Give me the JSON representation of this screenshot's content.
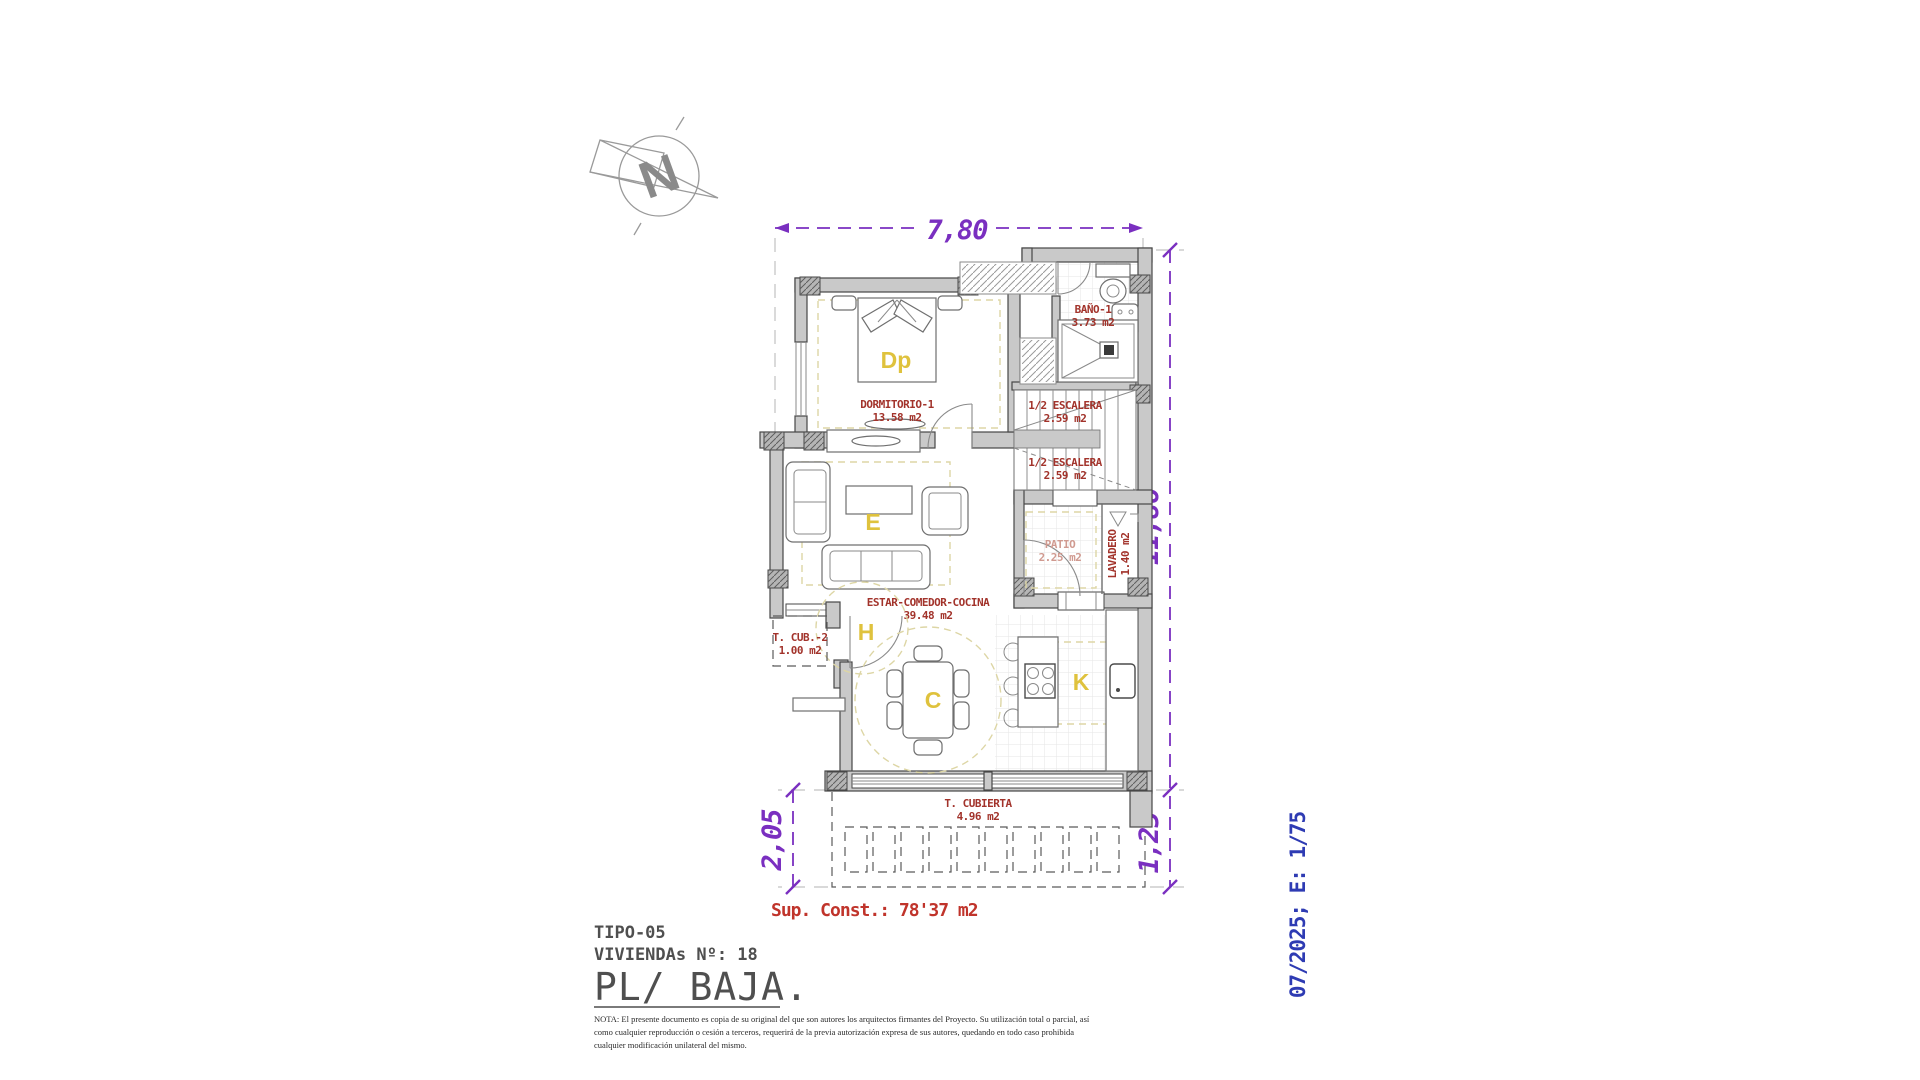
{
  "compass": {
    "letter": "N"
  },
  "dimensions": {
    "top": "7,80",
    "right_upper": "11,86",
    "right_lower": "1,25",
    "left": "2,05"
  },
  "rooms": {
    "bano": {
      "name": "BAÑO-1",
      "area": "3.73 m2"
    },
    "dormitorio": {
      "name": "DORMITORIO-1",
      "area": "13.58 m2"
    },
    "escalera": {
      "name": "1/2 ESCALERA",
      "area": "2.59 m2"
    },
    "patio": {
      "name": "PATIO",
      "area": "2.25 m2"
    },
    "lavadero": {
      "name": "LAVADERO",
      "area": "1.40 m2"
    },
    "estar": {
      "name": "ESTAR-COMEDOR-COCINA",
      "area": "39.48 m2"
    },
    "t_cub2": {
      "name": "T. CUB.-2",
      "area": "1.00 m2"
    },
    "t_cubierta": {
      "name": "T. CUBIERTA",
      "area": "4.96 m2"
    }
  },
  "letters": {
    "dormitorio": "Dp",
    "estar": "E",
    "hall": "H",
    "comedor": "C",
    "cocina": "K"
  },
  "summary": {
    "sup_const": "Sup. Const.: 78'37 m2"
  },
  "title_block": {
    "tipo": "TIPO-05",
    "viviendas": "VIVIENDAs Nº: 18",
    "plano": "PL/ BAJA."
  },
  "side_note": {
    "text": "07/2025; E: 1/75"
  },
  "nota": {
    "line1": "NOTA: El presente documento es copia de su original del que son autores los arquitectos firmantes del Proyecto. Su utilización total o parcial, así",
    "line2": "como cualquier reproducción o cesión a terceros, requerirá  de la previa autorización expresa de sus autores, quedando en todo caso prohibida",
    "line3": "cualquier modificación unilateral del mismo."
  },
  "colors": {
    "dimension_purple": "#7a2fc0",
    "room_label_red": "#a2332b",
    "summary_red": "#c0342b",
    "zone_letter_yellow": "#dfc23d",
    "side_note_blue": "#2e3bb3",
    "title_gray": "#4f4f4f",
    "wall_gray": "#c9c9c9"
  }
}
